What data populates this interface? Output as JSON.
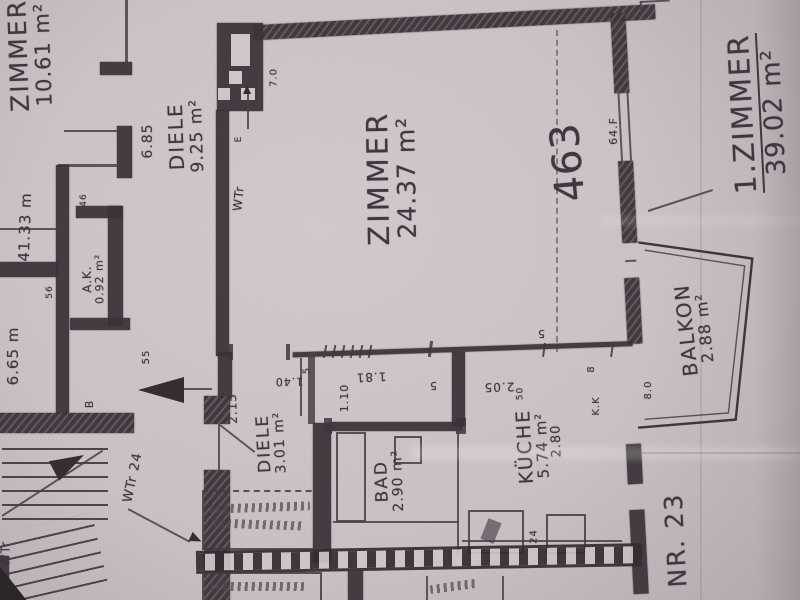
{
  "plan": {
    "colors": {
      "paper": "#cfc5c9",
      "ink": "#3b333b"
    },
    "rooms": {
      "zimmer_small": {
        "name": "ZIMMER",
        "area": "10.61 m²"
      },
      "diele_upper": {
        "name": "DIELE",
        "area": "9.25 m²"
      },
      "zimmer_main": {
        "name": "ZIMMER",
        "area": "24.37 m²"
      },
      "zimmer_total": {
        "name": "1.ZIMMER",
        "area": "39.02 m²"
      },
      "balkon": {
        "name": "BALKON",
        "area": "2.88 m²"
      },
      "diele_lower": {
        "name": "DIELE",
        "area": "3.01 m²"
      },
      "bad": {
        "name": "BAD",
        "area": "2.90 m²"
      },
      "kueche": {
        "name": "KÜCHE",
        "area": "5.74 m²"
      },
      "abstellkammer": {
        "name": "A.K.",
        "area": "0.92 m²"
      }
    },
    "dimensions": {
      "diele_width": "6.85",
      "wall_left_a": "41.33 m",
      "wall_left_b": "6.65 m",
      "d215": "2.15",
      "d140": "1.40",
      "d110": "1.10",
      "d181": "1.81",
      "d205": "2.05",
      "d280": "2.80",
      "d5a": "5",
      "d5b": "5",
      "d5c": "5",
      "d50": "50",
      "d24": "24",
      "d70": "7.0",
      "d55": "55",
      "d56": "56",
      "d46": "46",
      "d8": "8",
      "d80": "8.0"
    },
    "marks": {
      "shaft": "WTr",
      "stair": "WTr 24",
      "stair_edge": "WTr",
      "room_number": "463",
      "apartment_number": "NR. 23",
      "window": "64.F",
      "kitchen_duct": "K.K",
      "door_b": "B",
      "mark_e": "E"
    }
  }
}
